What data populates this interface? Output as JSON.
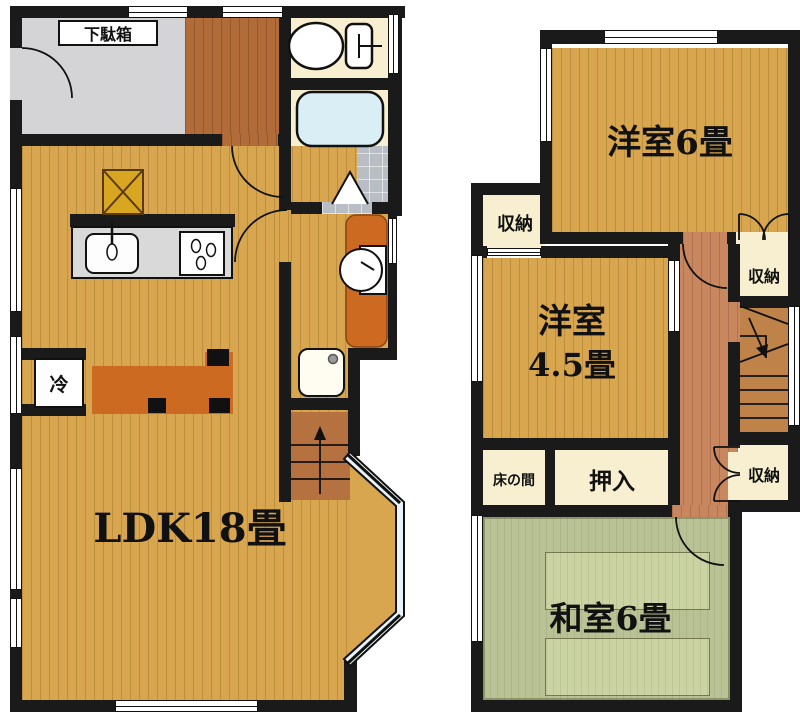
{
  "title": "2-story house floor plan",
  "floor1": {
    "labels": {
      "shoe_cabinet": "下駄箱",
      "fridge": "冷",
      "ldk": "LDK18畳"
    },
    "fixtures": [
      "toilet-icon",
      "bathtub-icon",
      "bath-folding-door-icon",
      "vanity-sink-icon",
      "washing-machine-pan-icon",
      "kitchen-sink-icon",
      "stove-icon",
      "pillar-icon",
      "stairs-up-icon",
      "bay-window-icon",
      "refrigerator-space"
    ]
  },
  "floor2": {
    "labels": {
      "room6": "洋室6畳",
      "room45_line1": "洋室",
      "room45_line2": "4.5畳",
      "washitsu": "和室6畳",
      "tokonoma": "床の間",
      "oshiire": "押入",
      "closet": "収納"
    },
    "fixtures": [
      "stairs-down-icon",
      "double-door-closet-icon",
      "room-door-icon"
    ]
  },
  "colors": {
    "wall": "#1a1a1a",
    "wood": "#d8a64e",
    "woodline": "#bf8f3c",
    "hall1": "#b26c3a",
    "hall2": "#c9875f",
    "stairs1": "#b5713f",
    "stairs2": "#bf8349",
    "tatami": "#b9c295",
    "tatamilight": "#cbd3a3",
    "cream": "#f7efcf",
    "grayfloor": "#d4d4d6",
    "tile": "#b9bdc4",
    "tub": "#d9eff5",
    "orange": "#cd6a22",
    "counter": "#d9d9d9",
    "pillar": "#d9a621",
    "glass": "#e8f4f7"
  }
}
